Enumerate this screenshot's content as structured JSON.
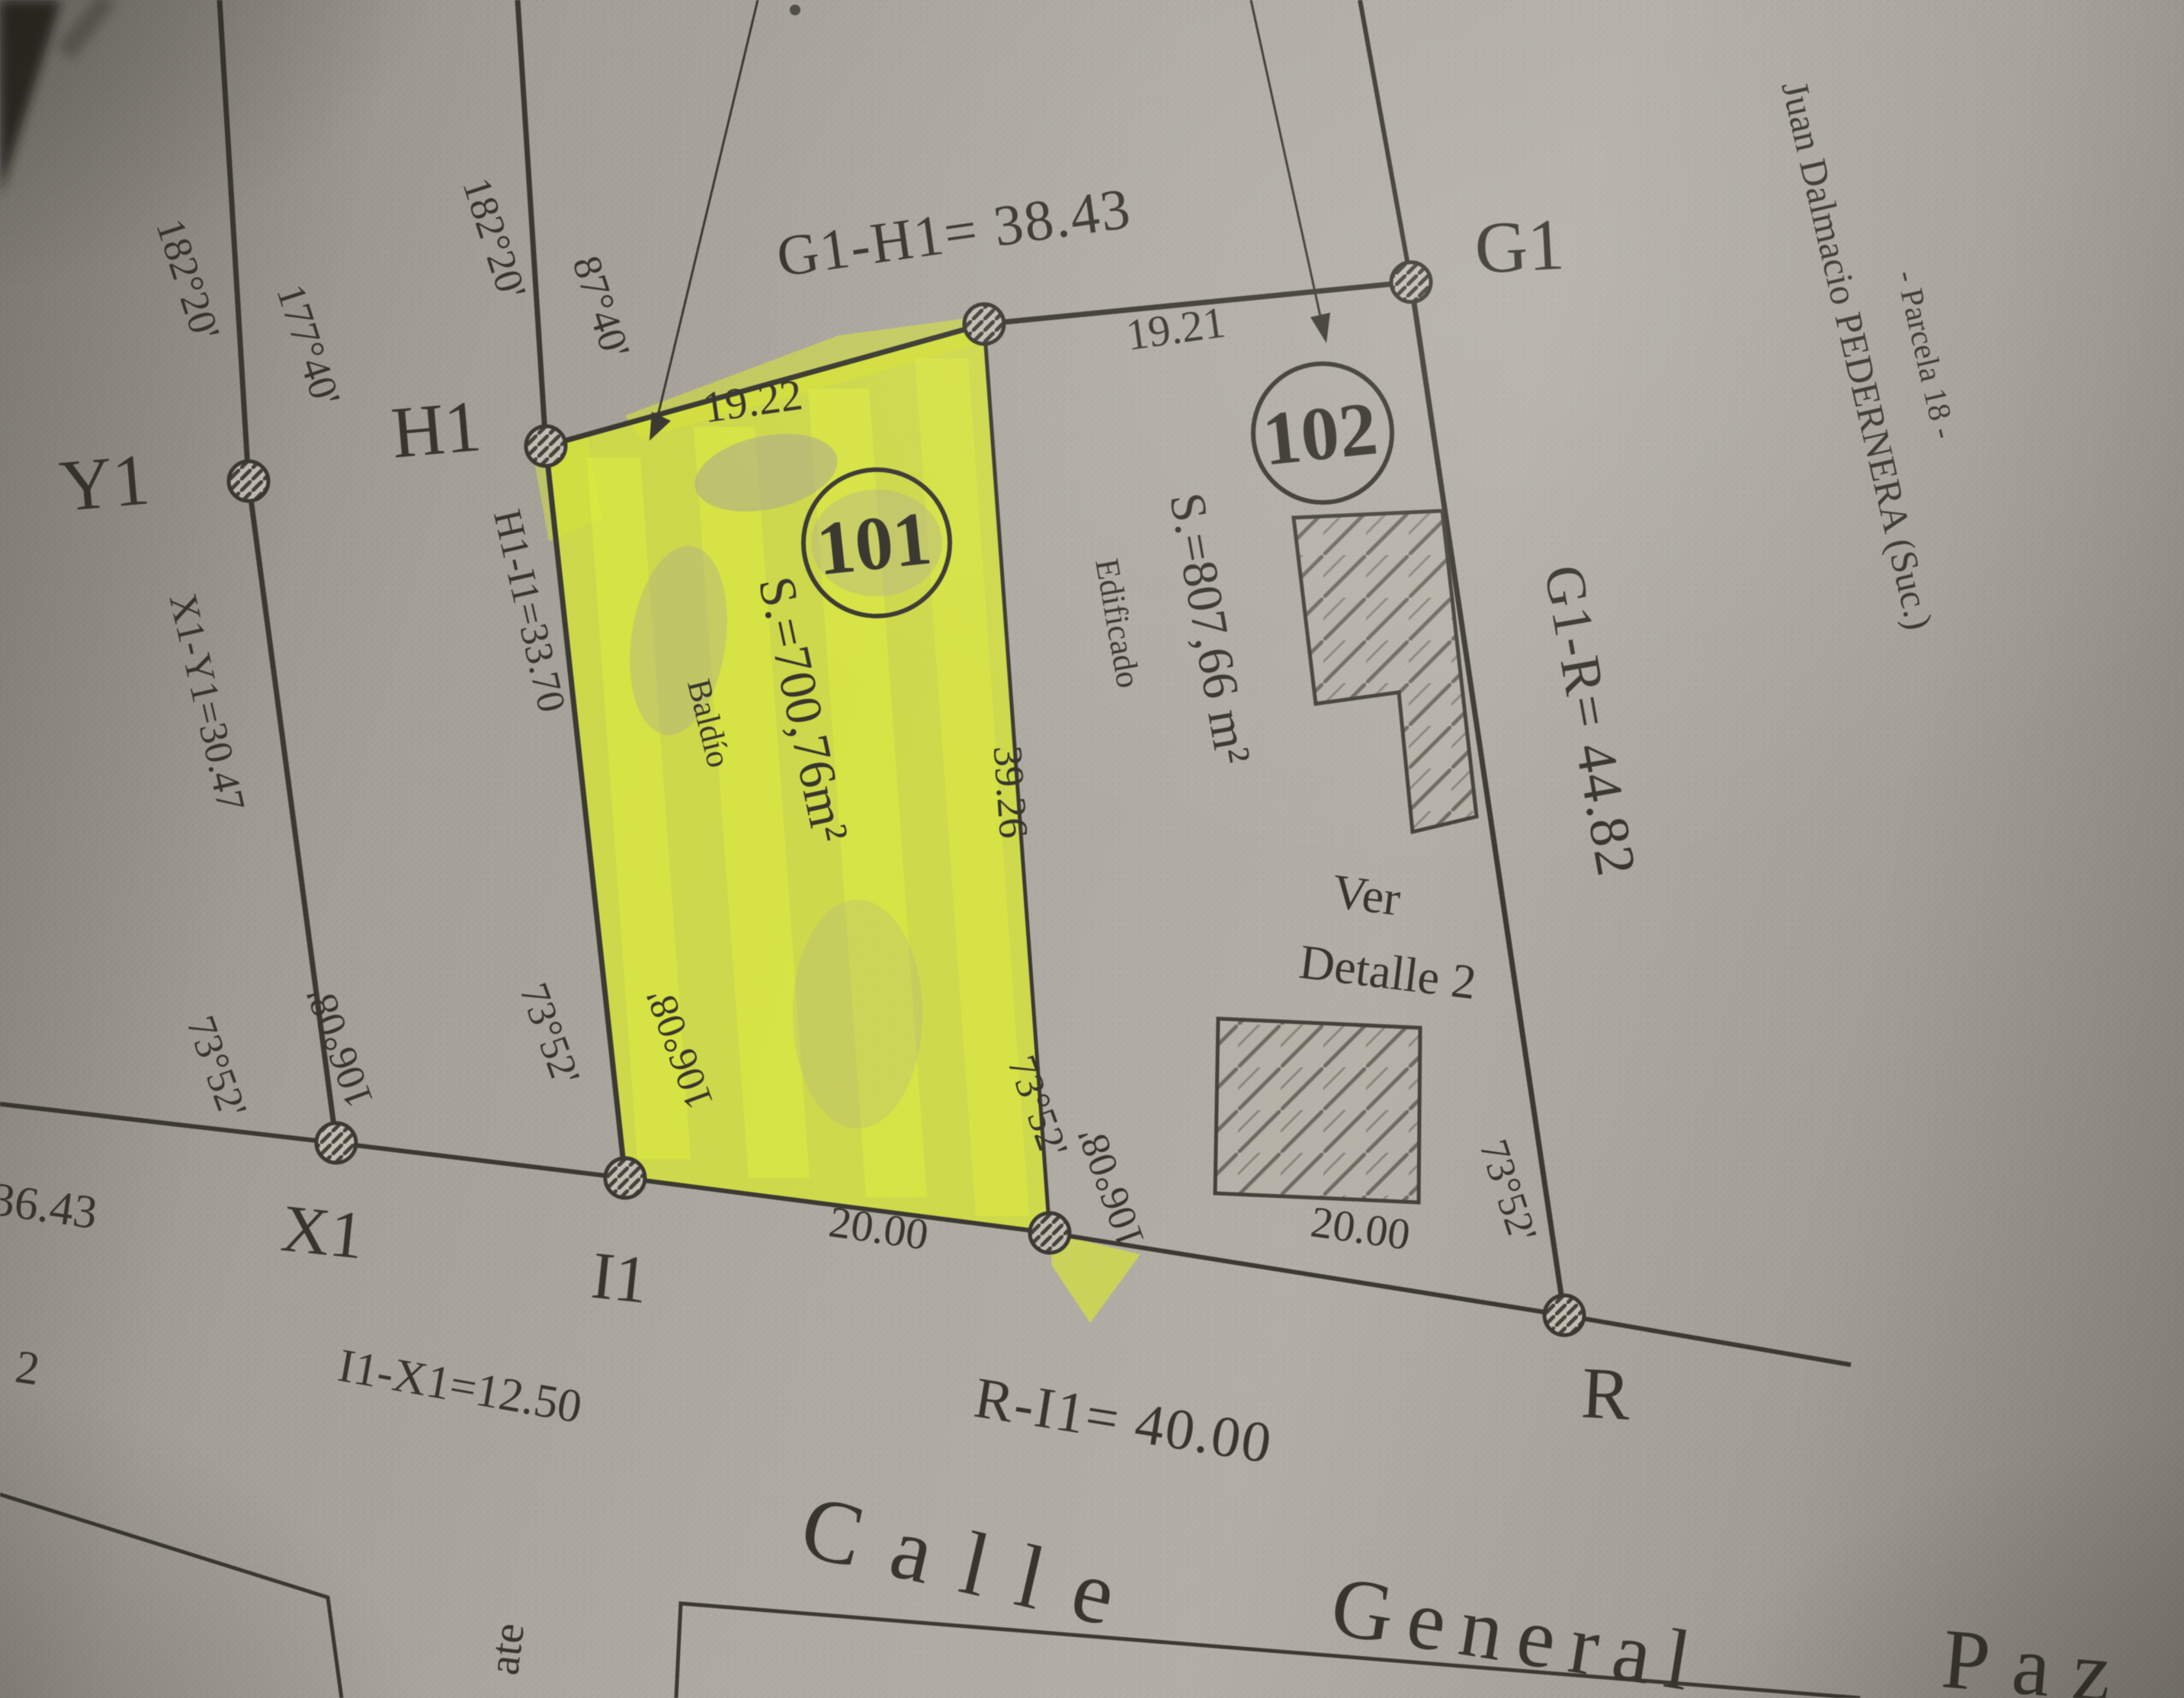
{
  "plan": {
    "street": {
      "word1": "Calle",
      "word2": "General",
      "word3": "Paz"
    },
    "parcels": {
      "p101": {
        "number": "101",
        "area": "S.=700,76m²",
        "condition": "Baldío",
        "front": "20.00",
        "side": "39.26",
        "back": "19.22"
      },
      "p102": {
        "number": "102",
        "area": "S.=807,66 m²",
        "condition": "Edificado",
        "front": "20.00",
        "back": "19.21",
        "note1": "Ver",
        "note2": "Detalle 2"
      }
    },
    "points": {
      "y1": "Y1",
      "h1": "H1",
      "g1": "G1",
      "x1": "X1",
      "i1": "I1",
      "r": "R"
    },
    "measures": {
      "g1h1": "G1-H1= 38.43",
      "h1i1": "H1-I1=33.70",
      "x1y1": "X1-Y1=30.47",
      "i1x1": "I1-X1=12.50",
      "ri1": "R-I1= 40.00",
      "g1r": "G1-R= 44.82",
      "left_partial": "36.43",
      "left_partial2": "2"
    },
    "angles": {
      "a182": "182°20'",
      "a177": "177°40'",
      "a87": "87°40'",
      "a73": "73°52'",
      "a106": "106°08'"
    },
    "notes": {
      "owner": "Juan Dalmacio PEDERNERA (Suc.)",
      "parcel": "- Parcela 18 -",
      "bottom_partial": "ate"
    }
  }
}
